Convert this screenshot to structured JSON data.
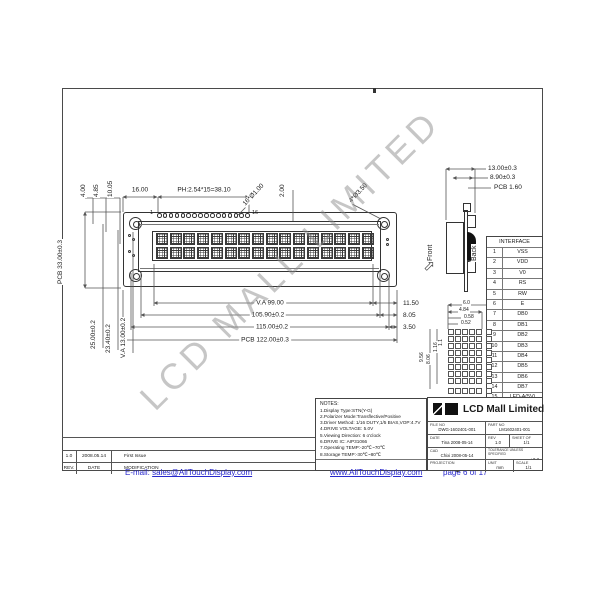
{
  "watermark": {
    "text": "LCD MALL LIMITED"
  },
  "front_view": {
    "pin_count": 16,
    "pin_first_label": "1",
    "pin_last_label": "16",
    "char_columns": 16,
    "char_rows": 2,
    "dims_top": {
      "offset1": "4.00",
      "offset2": "4.85",
      "offset3": "10.05",
      "conn_start": "16.00",
      "pitch": "PH:2.54*15=38.10",
      "pin_hole": "16*Ø1.00",
      "gap": "2.00",
      "mount_hole": "4*Ø3.50"
    },
    "dims_left": {
      "pcb_height": "PCB 33.00±0.3",
      "hole_spacing": "25.00±0.2",
      "frame_height": "23.40±0.2",
      "va_height": "V.A 13.00±0.2"
    },
    "dims_bottom": {
      "va_width": "V.A 99.00",
      "bezel_width": "105.90±0.2",
      "module_width": "115.00±0.2",
      "pcb_width": "PCB 122.00±0.3",
      "right1": "11.50",
      "right2": "8.05",
      "right3": "3.50"
    }
  },
  "side_view": {
    "front_label": "Front",
    "back_label": "Back",
    "dims": {
      "total": "13.00±0.3",
      "module": "8.90±0.3",
      "pcb": "PCB 1.60"
    }
  },
  "interface_table": {
    "title": "INTERFACE",
    "pins": [
      {
        "no": "1",
        "name": "VSS"
      },
      {
        "no": "2",
        "name": "VDD"
      },
      {
        "no": "3",
        "name": "V0"
      },
      {
        "no": "4",
        "name": "RS"
      },
      {
        "no": "5",
        "name": "RW"
      },
      {
        "no": "6",
        "name": "E"
      },
      {
        "no": "7",
        "name": "DB0"
      },
      {
        "no": "8",
        "name": "DB1"
      },
      {
        "no": "9",
        "name": "DB2"
      },
      {
        "no": "10",
        "name": "DB3"
      },
      {
        "no": "11",
        "name": "DB4"
      },
      {
        "no": "12",
        "name": "DB5"
      },
      {
        "no": "13",
        "name": "DB6"
      },
      {
        "no": "14",
        "name": "DB7"
      },
      {
        "no": "15",
        "name": "LED-A(5V)"
      },
      {
        "no": "16",
        "name": "LED-K"
      }
    ]
  },
  "dot_detail": {
    "grid_cols": 5,
    "grid_rows": 8,
    "dims_top": {
      "pitch_x": "6.0",
      "char_width": "4.84",
      "dot_a": "0.58",
      "dot_b": "0.52"
    },
    "dims_left": {
      "pitch_y": "9.56",
      "char_height": "8.06",
      "dot_c": "1.16",
      "dot_d": "1.1"
    }
  },
  "notes": {
    "title": "NOTES:",
    "lines": [
      "1.Display Type:STN(Y-G)",
      "2.Polarizer Mode:Transflective/Positive",
      "3.Driver Method: 1/16 DUTY,1/5 BIAS,VOP:4.7V",
      "4.DRIVE VOLTAGE: 5.0V",
      "5.Viewing Direction: 6 o'clock",
      "6.DRIVE IC: AIP31066",
      "7.Operating TEMP:-20℃~70℃",
      "8.Storage TEMP:-30℃~80℃"
    ]
  },
  "title_block": {
    "company": "LCD Mall Limited",
    "file_no_label": "FILE NO",
    "file_no": "DWG-1602401-001",
    "part_no_label": "PART NO",
    "part_no": "LM1602401-001",
    "date_label": "DATE",
    "date": "Tina  2008-05-14",
    "rev_label": "REV",
    "rev": "1.0",
    "sheet_label": "SHEET OF",
    "sheet": "1/1",
    "cad_label": "CAD",
    "cad": "Chixi  2008-05-14",
    "tol_label": "TOLERANCE UNLESS SPECIFIED",
    "tol": "±0.3",
    "projection_label": "PROJECTION",
    "projection": "3rd ANGLE",
    "unit_label": "UNIT",
    "unit": "mm",
    "scale_label": "SCALE",
    "scale": "1/1"
  },
  "revision_table": {
    "data_row": {
      "rev": "1.0",
      "date": "2008.05.14",
      "modification": "First Issue"
    },
    "header_row": {
      "rev": "REV.",
      "date": "DATE",
      "modification": "MODIFICATION"
    }
  },
  "footer": {
    "email_label": "E-mail:",
    "email_link": "sales@AllTouchDisplay.com",
    "website": "www.AllTouchDisplay.com",
    "page_label": "page 6 of 17"
  }
}
